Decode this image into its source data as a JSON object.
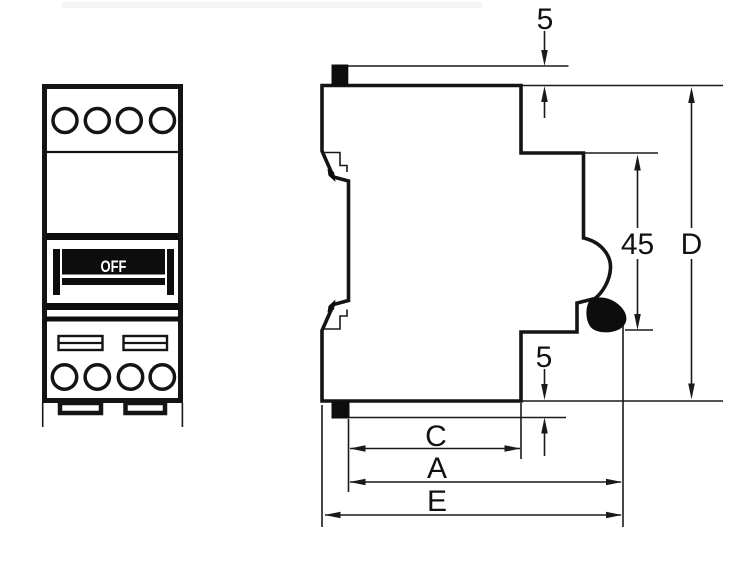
{
  "front_view": {
    "switch_label": "OFF"
  },
  "dimensions": {
    "top_protrusion": {
      "label": "5"
    },
    "din_recess": {
      "label": "45"
    },
    "overall_height": {
      "label": "D"
    },
    "bottom_protrusion": {
      "label": "5"
    },
    "depth_c": {
      "label": "C"
    },
    "depth_a": {
      "label": "A"
    },
    "depth_e": {
      "label": "E"
    }
  },
  "colors": {
    "line": "#141414",
    "background": "#ffffff",
    "switch_fill": "#0d0d0d",
    "switch_label_color": "#ffffff"
  }
}
